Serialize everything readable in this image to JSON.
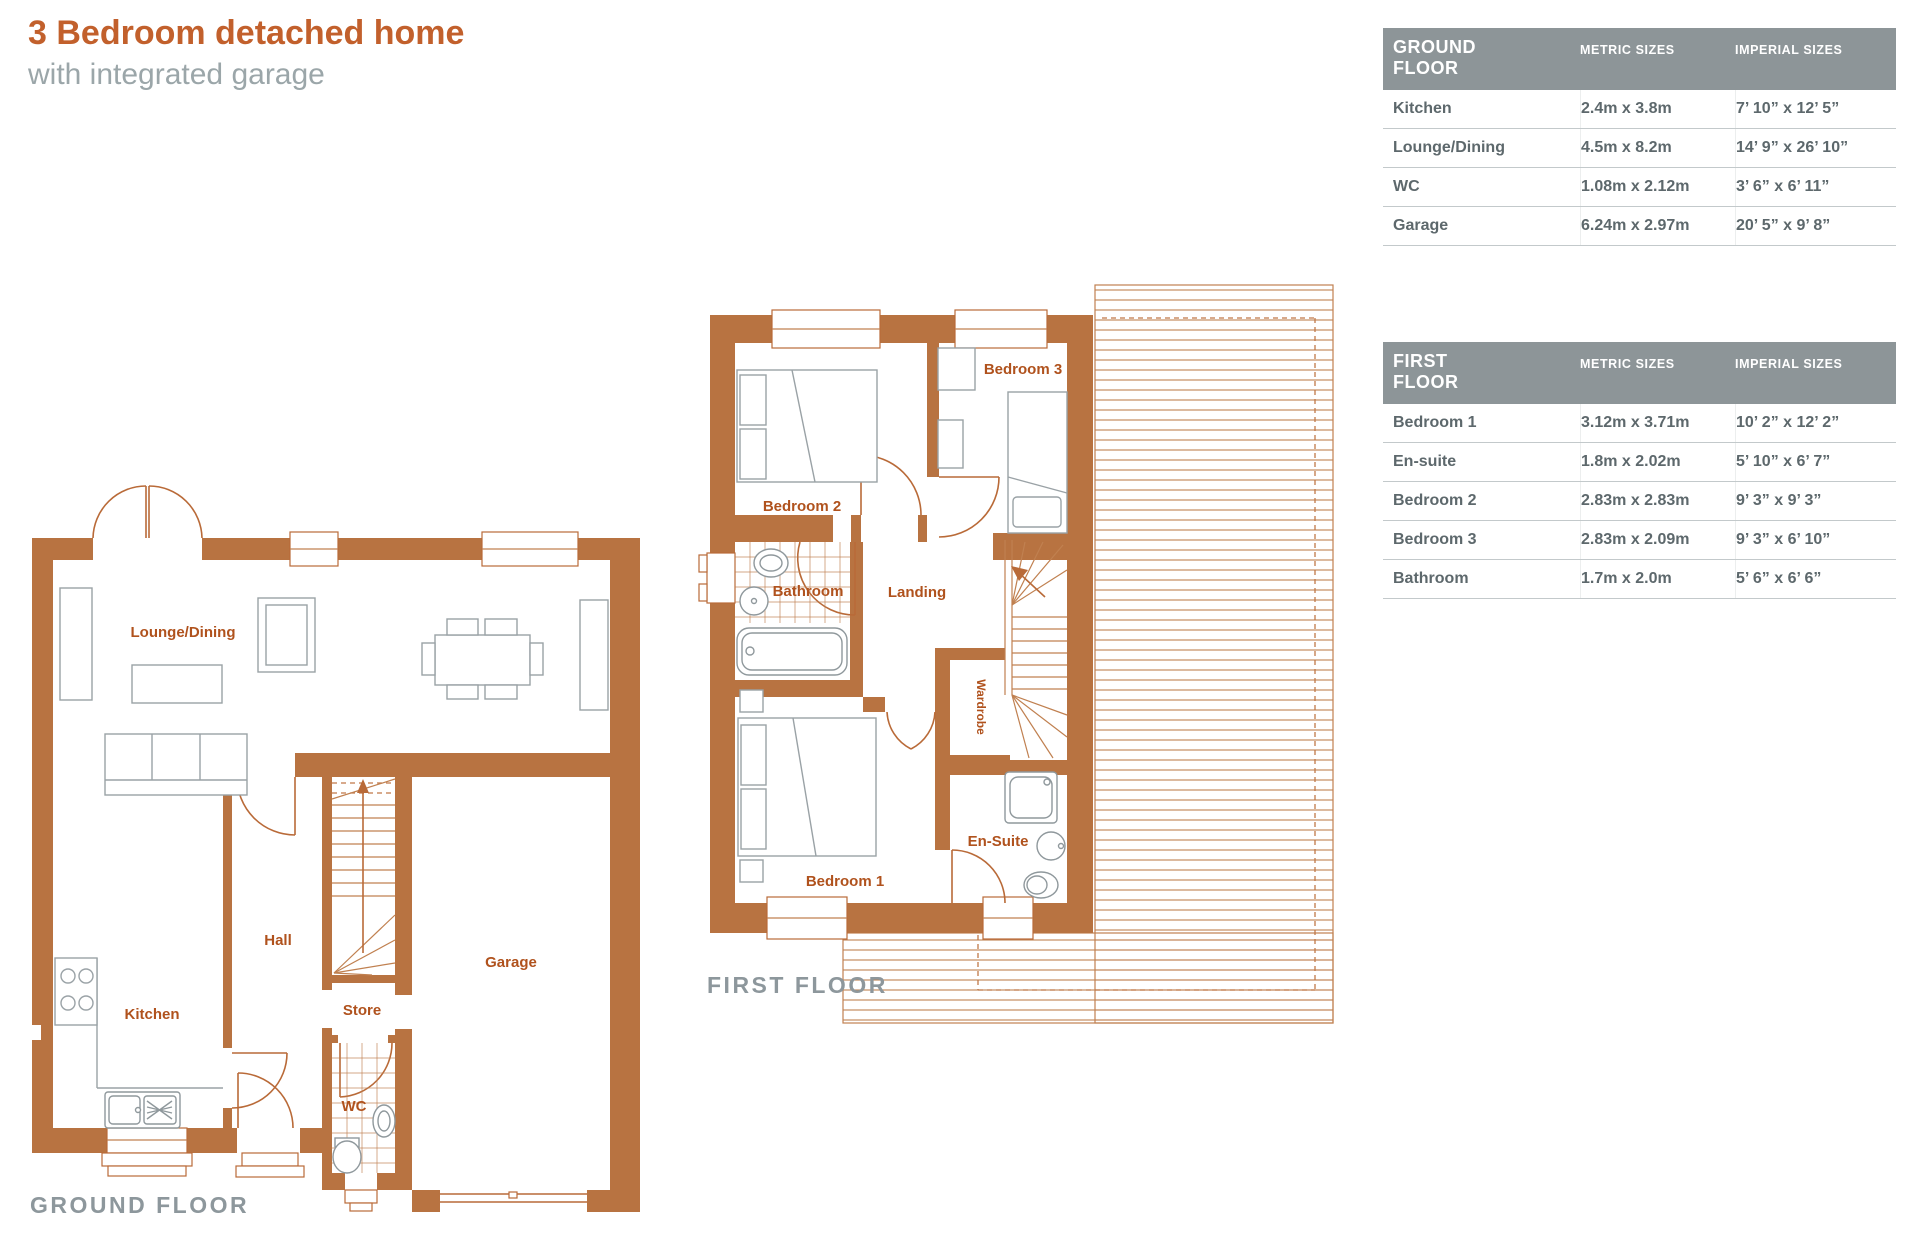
{
  "header": {
    "title": "3 Bedroom detached home",
    "subtitle": "with integrated garage"
  },
  "colors": {
    "accent_orange": "#c2602c",
    "wall_terracotta": "#b87341",
    "plan_label_orange": "#b0521d",
    "caption_gray": "#8d979c",
    "table_header_bg": "#8d9598",
    "table_text": "#5d686c"
  },
  "tables": {
    "ground": {
      "floor_label": "GROUND FLOOR",
      "metric_header": "METRIC SIZES",
      "imperial_header": "IMPERIAL SIZES",
      "rows": [
        {
          "room": "Kitchen",
          "metric": "2.4m x 3.8m",
          "imperial": "7’ 10” x 12’ 5”"
        },
        {
          "room": "Lounge/Dining",
          "metric": "4.5m x 8.2m",
          "imperial": "14’ 9” x 26’ 10”"
        },
        {
          "room": "WC",
          "metric": "1.08m x 2.12m",
          "imperial": "3’ 6” x 6’ 11”"
        },
        {
          "room": "Garage",
          "metric": "6.24m x 2.97m",
          "imperial": "20’ 5” x 9’ 8”"
        }
      ]
    },
    "first": {
      "floor_label": "FIRST FLOOR",
      "metric_header": "METRIC SIZES",
      "imperial_header": "IMPERIAL SIZES",
      "rows": [
        {
          "room": "Bedroom 1",
          "metric": "3.12m x 3.71m",
          "imperial": "10’ 2” x 12’ 2”"
        },
        {
          "room": "En-suite",
          "metric": "1.8m x 2.02m",
          "imperial": "5’ 10” x 6’ 7”"
        },
        {
          "room": "Bedroom 2",
          "metric": "2.83m x 2.83m",
          "imperial": "9’ 3” x 9’ 3”"
        },
        {
          "room": "Bedroom 3",
          "metric": "2.83m x 2.09m",
          "imperial": "9’ 3” x 6’ 10”"
        },
        {
          "room": "Bathroom",
          "metric": "1.7m x 2.0m",
          "imperial": "5’ 6” x 6’ 6”"
        }
      ]
    }
  },
  "plans": {
    "ground": {
      "caption": "GROUND FLOOR",
      "rooms": {
        "lounge": "Lounge/Dining",
        "kitchen": "Kitchen",
        "hall": "Hall",
        "store": "Store",
        "wc": "WC",
        "garage": "Garage"
      }
    },
    "first": {
      "caption": "FIRST FLOOR",
      "rooms": {
        "bedroom1": "Bedroom 1",
        "bedroom2": "Bedroom 2",
        "bedroom3": "Bedroom 3",
        "bathroom": "Bathroom",
        "landing": "Landing",
        "wardrobe": "Wardrobe",
        "ensuite": "En-Suite"
      }
    }
  }
}
